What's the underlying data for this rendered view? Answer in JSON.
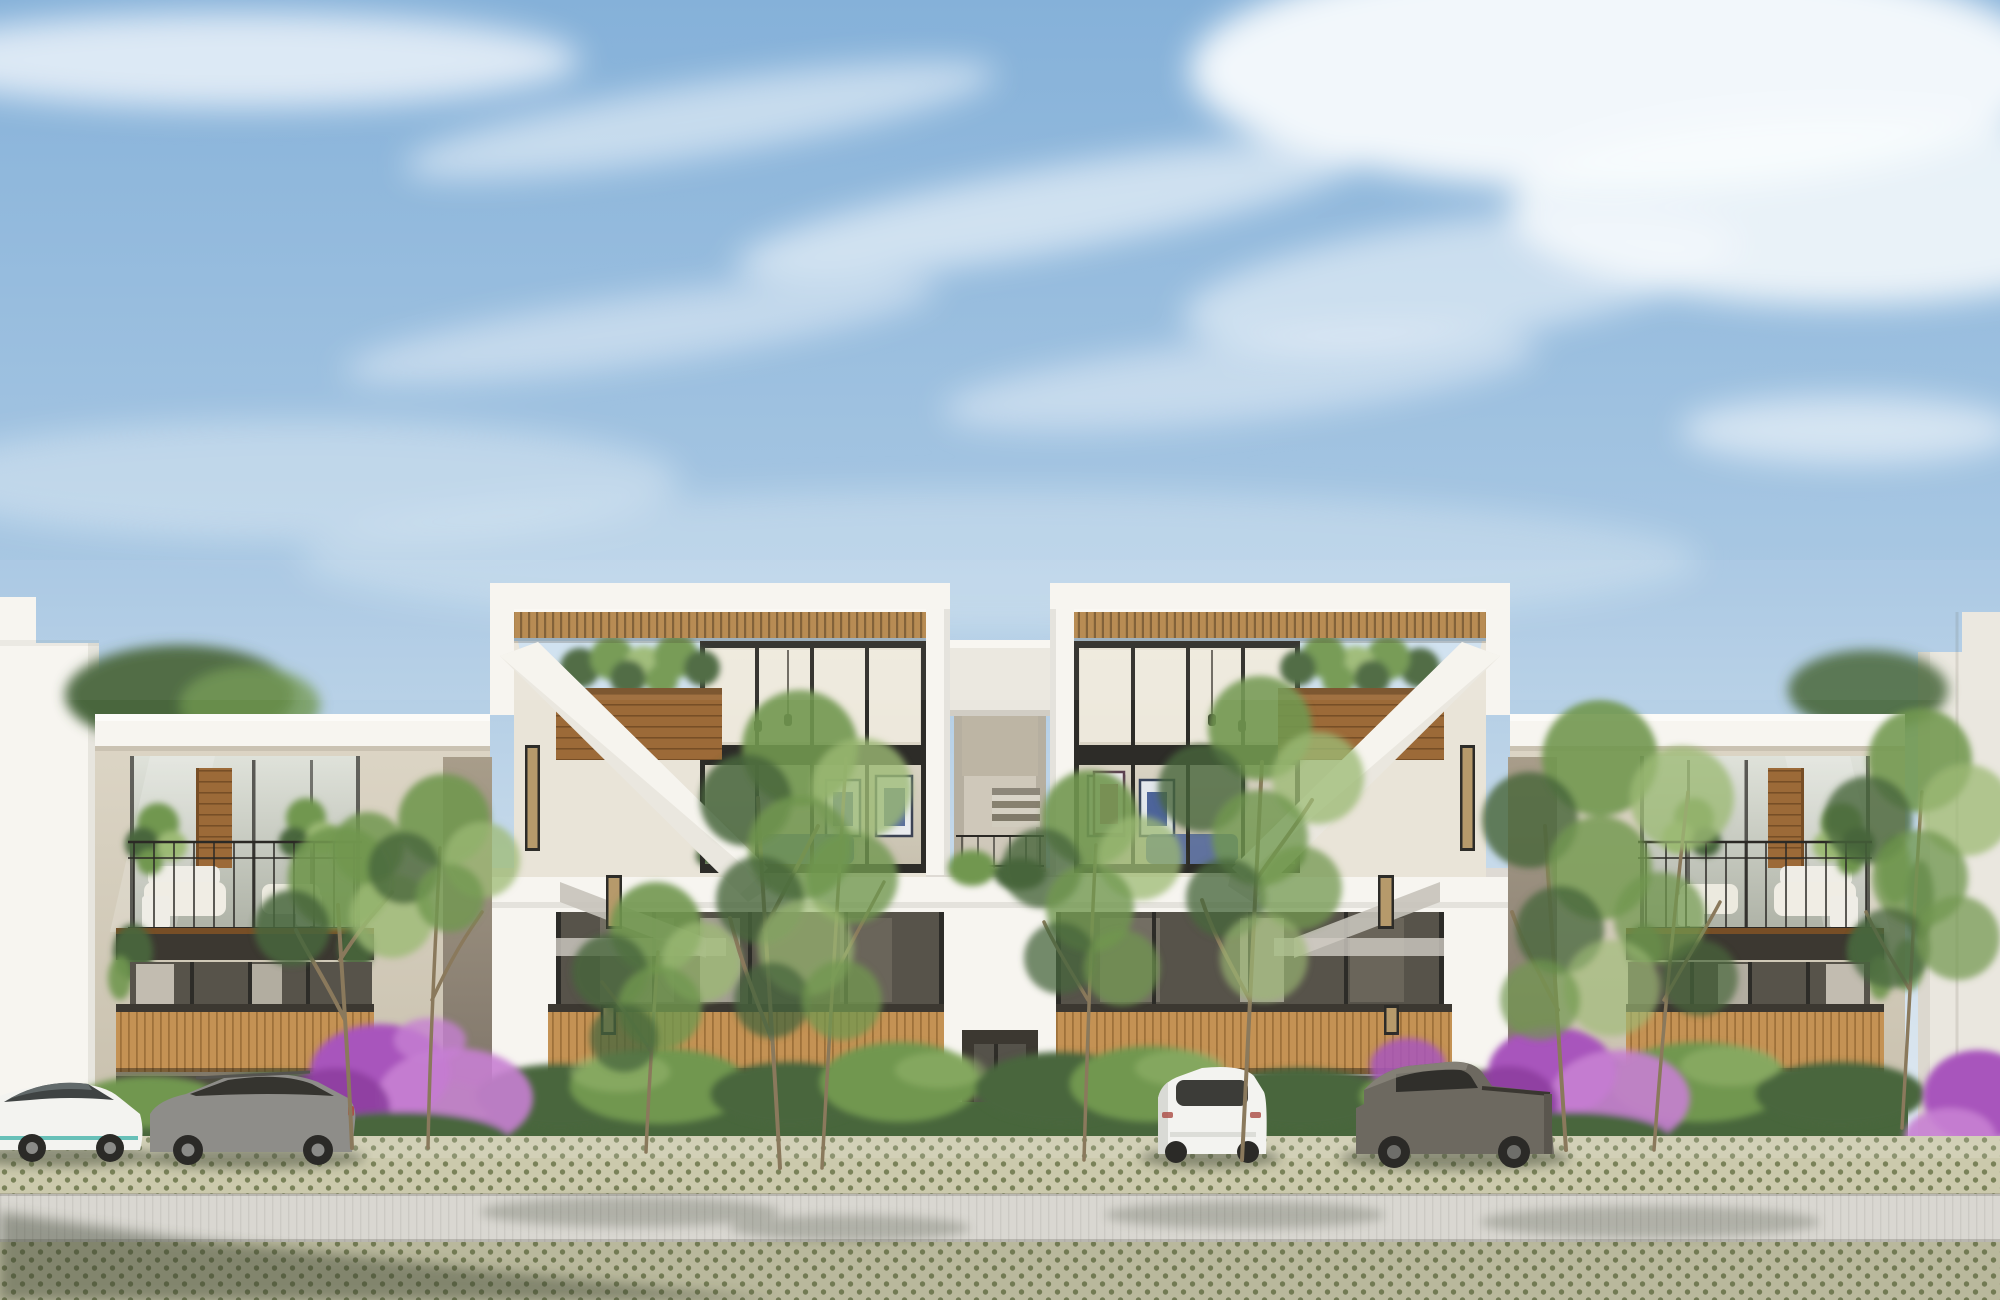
{
  "scene": {
    "type": "architectural exterior rendering",
    "subject": "modern three-story residential complex street elevation",
    "time_of_day": "sunny day",
    "sky": {
      "condition": "blue with wispy clouds",
      "bright_area": "upper right"
    },
    "buildings": {
      "left_neighbor": {
        "description": "partial plain white building at far left edge"
      },
      "left_wing": {
        "floors": 3,
        "features": [
          "white roof parapet",
          "recessed top balcony with black metal railing and potted plants",
          "dark balcony fascia",
          "honey wood-slat balcony band on middle floor",
          "hedge at street level"
        ]
      },
      "center_block": {
        "penthouse_towers": 2,
        "features": [
          "white box frames",
          "wood slat pergola roofs",
          "open roof terraces with wood planter boxes",
          "double-height glass walls with black mullions",
          "diagonal white exterior stair parapets",
          "staggered narrow slit windows",
          "recessed central stair core with bridge parapet",
          "central dark entry portal",
          "wood-slat balcony bands on second floor"
        ]
      },
      "right_wing": {
        "floors": 3,
        "features": [
          "mirror of left wing",
          "top balcony with tall potted plants",
          "hanging greenery",
          "wood-slat balcony band"
        ]
      },
      "right_neighbor": {
        "description": "partial white building at far right edge"
      }
    },
    "interiors_visible": [
      "framed wall art",
      "pendant lamps on cords",
      "blue sofa and furniture silhouettes",
      "white lounge furniture",
      "sheer curtains"
    ],
    "vehicles": [
      {
        "type": "sedan",
        "color": "white",
        "position": "far left, partially cropped",
        "accent": "teal trim line"
      },
      {
        "type": "wagon-hatchback",
        "color": "gray",
        "position": "left"
      },
      {
        "type": "compact SUV",
        "color": "white",
        "position": "center right, rear view"
      },
      {
        "type": "pickup truck",
        "color": "dark warm gray",
        "position": "right"
      }
    ],
    "vegetation": {
      "street_trees": 7,
      "tree_style": "slender multi-trunk ornamental trees with airy canopies",
      "hedge": "continuous clipped hedge along the facade base",
      "bougainvillea": "purple flowering masses at left, right and far-right corner",
      "balcony_plants": "potted leafy plants, planter boxes and trailing vines"
    },
    "ground": {
      "parking_strip": "grass-grid permeable pavers",
      "road": "smooth light concrete band with fine vertical scoring",
      "foreground": "grass-grid pavers with long shadow at lower left"
    }
  },
  "palette": {
    "sky_top": "#85b1d9",
    "sky_mid": "#a9c8e3",
    "sky_horizon": "#d6e3ee",
    "sky_open": "#cfe1f0",
    "cloud": "#f8fbfd",
    "wall_white": "#f7f5f0",
    "wall_white_shade": "#eae7df",
    "stucco": "#dcd5c5",
    "stucco_shade": "#c8c0ad",
    "recess_taupe": "#a19580",
    "pergola_wood": "#b5864b",
    "pergola_wood_dark": "#7c5a30",
    "planter_wood": "#9c6a38",
    "planter_wood_dark": "#774e26",
    "deck_wood": "#c49254",
    "deck_wood_dark": "#9e713a",
    "fascia_dark": "#3c3831",
    "mullion": "#2d2c28",
    "glass_dark": "#57534a",
    "glass_amber": "#b69a6b",
    "railing": "#2b2925",
    "foliage_light": "#9cba74",
    "foliage_mid": "#71974f",
    "foliage_dark": "#48663c",
    "trunk": "#8a795c",
    "bougainvillea": "#a855bc",
    "bougainvillea_light": "#c67fd2",
    "bougainvillea_dark": "#8d3f9f",
    "pot_white": "#efede6",
    "curtain": "#efe9db",
    "paver_base": "#cbc9ac",
    "paver_dot": "#7a8259",
    "road": "#d9d7d1",
    "soil": "#6b7551",
    "shadow": "#39402f",
    "car_white": "#f3f3f0",
    "car_gray": "#8e8d89",
    "car_pickup": "#6d6960",
    "tire": "#2b2a27",
    "art_blue": "#4d649a",
    "art_orange": "#c47b4a",
    "art_pink": "#b84f86"
  }
}
